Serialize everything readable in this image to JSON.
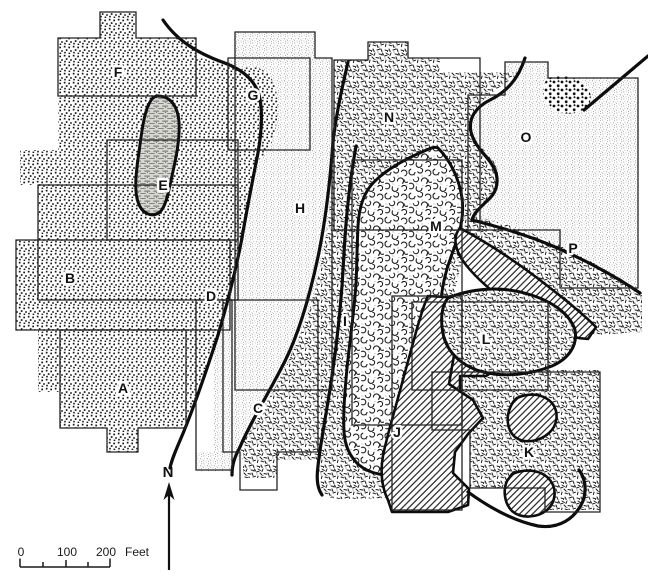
{
  "map": {
    "regions": [
      {
        "label": "A",
        "pattern": "coarse-stipple"
      },
      {
        "label": "B",
        "pattern": "coarse-stipple"
      },
      {
        "label": "C",
        "pattern": "dense-grit"
      },
      {
        "label": "D",
        "pattern": "coarse-stipple"
      },
      {
        "label": "E",
        "pattern": "horizontal-dash"
      },
      {
        "label": "F",
        "pattern": "coarse-stipple"
      },
      {
        "label": "G",
        "pattern": "coarse-stipple"
      },
      {
        "label": "H",
        "pattern": "fine-stipple"
      },
      {
        "label": "I",
        "pattern": "dense-grit"
      },
      {
        "label": "J",
        "pattern": "diagonal-hatch"
      },
      {
        "label": "K",
        "pattern": "dense-grit"
      },
      {
        "label": "L",
        "pattern": "dense-grit"
      },
      {
        "label": "M",
        "pattern": "open-circles"
      },
      {
        "label": "N",
        "pattern": "dense-grit"
      },
      {
        "label": "O",
        "pattern": "fine-stipple"
      },
      {
        "label": "P",
        "pattern": "dense-grit"
      }
    ],
    "north_arrow": {
      "label": "N"
    },
    "scale_bar": {
      "tick_labels": [
        "0",
        "100",
        "200"
      ],
      "unit_label": "Feet"
    }
  },
  "colors": {
    "ink": "#111111",
    "paper": "#ffffff"
  }
}
